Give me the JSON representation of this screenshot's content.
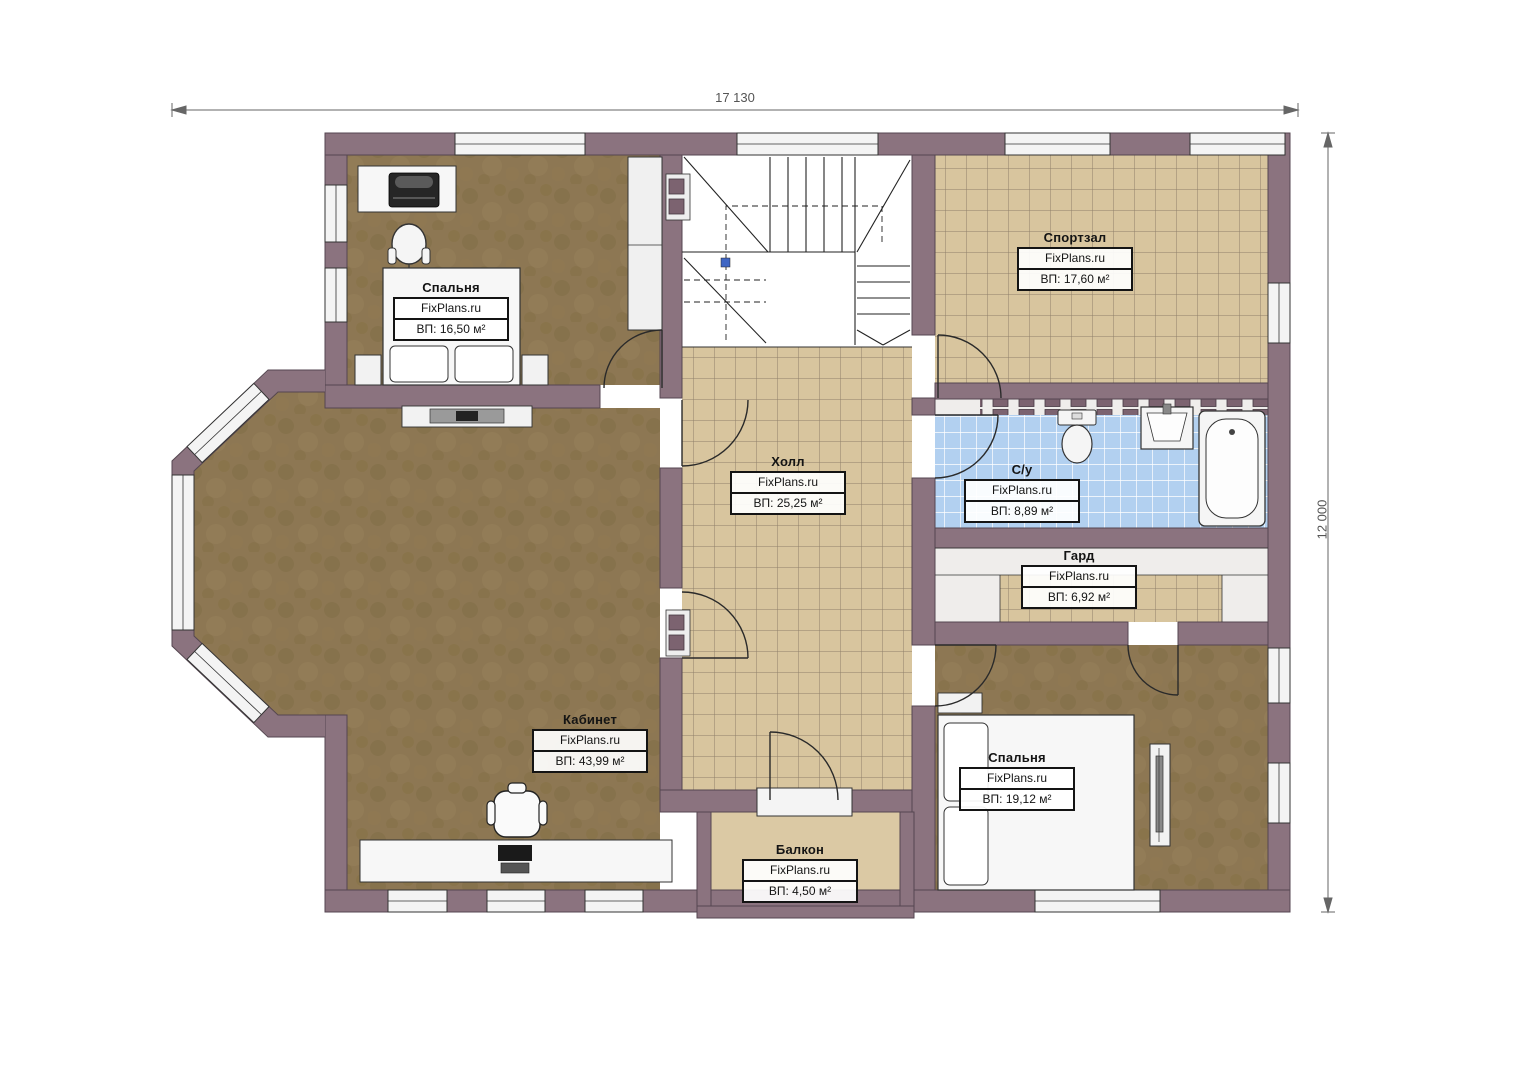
{
  "plan": {
    "type": "floor-plan",
    "watermark": "FixPlans.ru",
    "dimensions": {
      "width": "17 130",
      "height": "12 000"
    },
    "rooms": [
      {
        "id": "bedroom-1",
        "name": "Спальня",
        "brand": "FixPlans.ru",
        "area": "ВП: 16,50 м²"
      },
      {
        "id": "gym",
        "name": "Спортзал",
        "brand": "FixPlans.ru",
        "area": "ВП: 17,60 м²"
      },
      {
        "id": "hall",
        "name": "Холл",
        "brand": "FixPlans.ru",
        "area": "ВП: 25,25 м²"
      },
      {
        "id": "bathroom",
        "name": "С/у",
        "brand": "FixPlans.ru",
        "area": "ВП: 8,89 м²"
      },
      {
        "id": "wardrobe",
        "name": "Гард",
        "brand": "FixPlans.ru",
        "area": "ВП: 6,92 м²"
      },
      {
        "id": "office",
        "name": "Кабинет",
        "brand": "FixPlans.ru",
        "area": "ВП: 43,99 м²"
      },
      {
        "id": "bedroom-2",
        "name": "Спальня",
        "brand": "FixPlans.ru",
        "area": "ВП: 19,12 м²"
      },
      {
        "id": "balcony",
        "name": "Балкон",
        "brand": "FixPlans.ru",
        "area": "ВП: 4,50 м²"
      }
    ],
    "colors": {
      "wall": "#8b737f",
      "wood_floor": "#8d7753",
      "tile_floor": "#d8c59e",
      "bath_tile": "#b2d0f0",
      "balcony_floor": "#dbc9a4"
    }
  }
}
